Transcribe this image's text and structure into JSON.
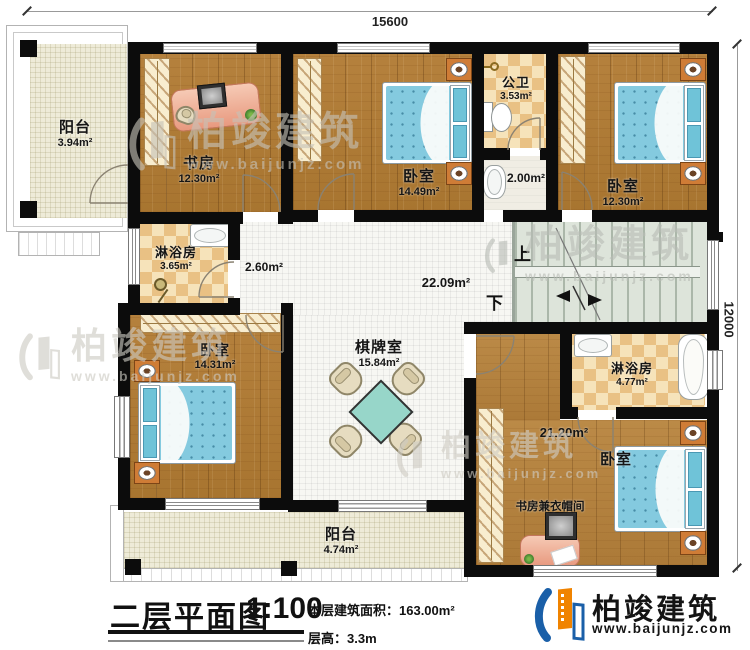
{
  "plan": {
    "dim_top": "15600",
    "dim_right": "12000",
    "stairs": {
      "up": "上",
      "down": "下"
    },
    "rooms": {
      "balcony_tl": {
        "name": "阳台",
        "area": "3.94m²"
      },
      "study": {
        "name": "书房",
        "area": "12.30m²"
      },
      "bedroom_top_mid": {
        "name": "卧室",
        "area": "14.49m²"
      },
      "public_bath": {
        "name": "公卫",
        "area": "3.53m²"
      },
      "vanity": {
        "area": "2.00m²"
      },
      "bedroom_top_right": {
        "name": "卧室",
        "area": "12.30m²"
      },
      "shower_left": {
        "name": "淋浴房",
        "area": "3.65m²"
      },
      "hall_small": {
        "area": "2.60m²"
      },
      "hall_main": {
        "area": "22.09m²"
      },
      "bedroom_left": {
        "name": "卧室",
        "area": "14.31m²"
      },
      "game_room": {
        "name": "棋牌室",
        "area": "15.84m²"
      },
      "shower_right": {
        "name": "淋浴房",
        "area": "4.77m²"
      },
      "bedroom_br": {
        "name": "卧室",
        "area": "21.20m²"
      },
      "study_closet": {
        "name": "书房兼衣帽间"
      },
      "balcony_bottom": {
        "name": "阳台",
        "area": "4.74m²"
      }
    }
  },
  "titleblock": {
    "title": "二层平面图",
    "scale": "1:100",
    "area_line": "本层建筑面积：163.00m²",
    "height_line": "层高：3.3m"
  },
  "brand": {
    "name": "柏竣建筑",
    "url": "www.baijunjz.com"
  },
  "watermark": {
    "name": "柏竣建筑",
    "url": "www.baijunjz.com"
  },
  "colors": {
    "brand_blue": "#1a5fa8",
    "brand_orange": "#f08300",
    "wall": "#0c0c0c"
  }
}
